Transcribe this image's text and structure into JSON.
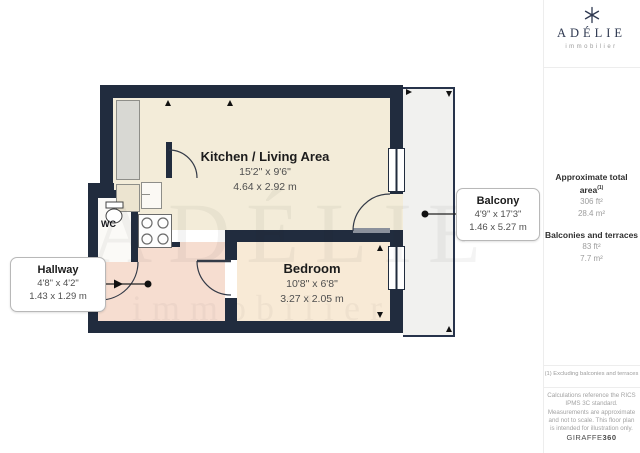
{
  "brand": {
    "name": "ADÉLIE",
    "tagline": "immobilier"
  },
  "watermark": {
    "line1": "ADÉLIE",
    "line2": "immobilier"
  },
  "rooms": {
    "kitchen_living": {
      "name": "Kitchen / Living Area",
      "imperial": "15'2\" x 9'6\"",
      "metric": "4.64 x 2.92 m"
    },
    "bedroom": {
      "name": "Bedroom",
      "imperial": "10'8\" x 6'8\"",
      "metric": "3.27 x 2.05 m"
    },
    "wc": {
      "name": "WC"
    }
  },
  "callouts": {
    "balcony": {
      "name": "Balcony",
      "imperial": "4'9\" x 17'3\"",
      "metric": "1.46 x 5.27 m"
    },
    "hallway": {
      "name": "Hallway",
      "imperial": "4'8\" x 4'2\"",
      "metric": "1.43 x 1.29 m"
    }
  },
  "sidebar": {
    "total_area_label": "Approximate total area",
    "total_area_sup": "(1)",
    "total_area_ft": "306 ft²",
    "total_area_m": "28.4 m²",
    "balconies_label": "Balconies and terraces",
    "balconies_ft": "83 ft²",
    "balconies_m": "7.7 m²",
    "footnote": "(1) Excluding balconies and terraces",
    "disclaimer": "Calculations reference the RICS IPMS 3C standard. Measurements are approximate and not to scale. This floor plan is intended for illustration only.",
    "brand_name": "GIRAFFE",
    "brand_suffix": "360"
  },
  "colors": {
    "wall": "#212c3e",
    "kitchen_floor": "#f3ecd9",
    "bedroom_floor": "#f8ead6",
    "hallway_floor": "#f6ddd0",
    "wc_floor": "#fbfaf7",
    "balcony_floor": "#f1f1ef",
    "closet_gray": "#d8d8d3",
    "callout_border": "#b8b8b8"
  }
}
